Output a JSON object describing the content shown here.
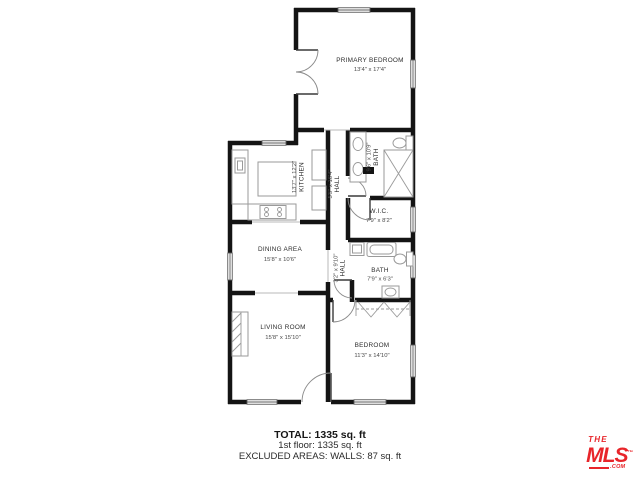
{
  "rooms": [
    {
      "name": "PRIMARY BEDROOM",
      "dims": "13'4\" x 17'4\""
    },
    {
      "name": "KITCHEN",
      "dims": "13'7\" x 12'2\""
    },
    {
      "name": "HALL",
      "dims": "5'5\" x 16'4\""
    },
    {
      "name": "BATH",
      "dims": "9'6\" x 10'9\""
    },
    {
      "name": "W.I.C.",
      "dims": "7'9\" x 8'2\""
    },
    {
      "name": "DINING AREA",
      "dims": "15'8\" x 10'6\""
    },
    {
      "name": "HALL",
      "dims": "3'2\" x 9'10\""
    },
    {
      "name": "BATH",
      "dims": "7'9\" x 6'3\""
    },
    {
      "name": "LIVING ROOM",
      "dims": "15'8\" x 15'10\""
    },
    {
      "name": "BEDROOM",
      "dims": "11'3\" x 14'10\""
    }
  ],
  "summary": {
    "total": "TOTAL: 1335 sq. ft",
    "floor1": "1st floor: 1335 sq. ft",
    "excluded": "EXCLUDED AREAS: WALLS: 87 sq. ft"
  },
  "logo": {
    "the": "THE",
    "mls": "MLS",
    "tm": "™",
    "com": ".COM",
    "brand_color": "#e8252a"
  }
}
